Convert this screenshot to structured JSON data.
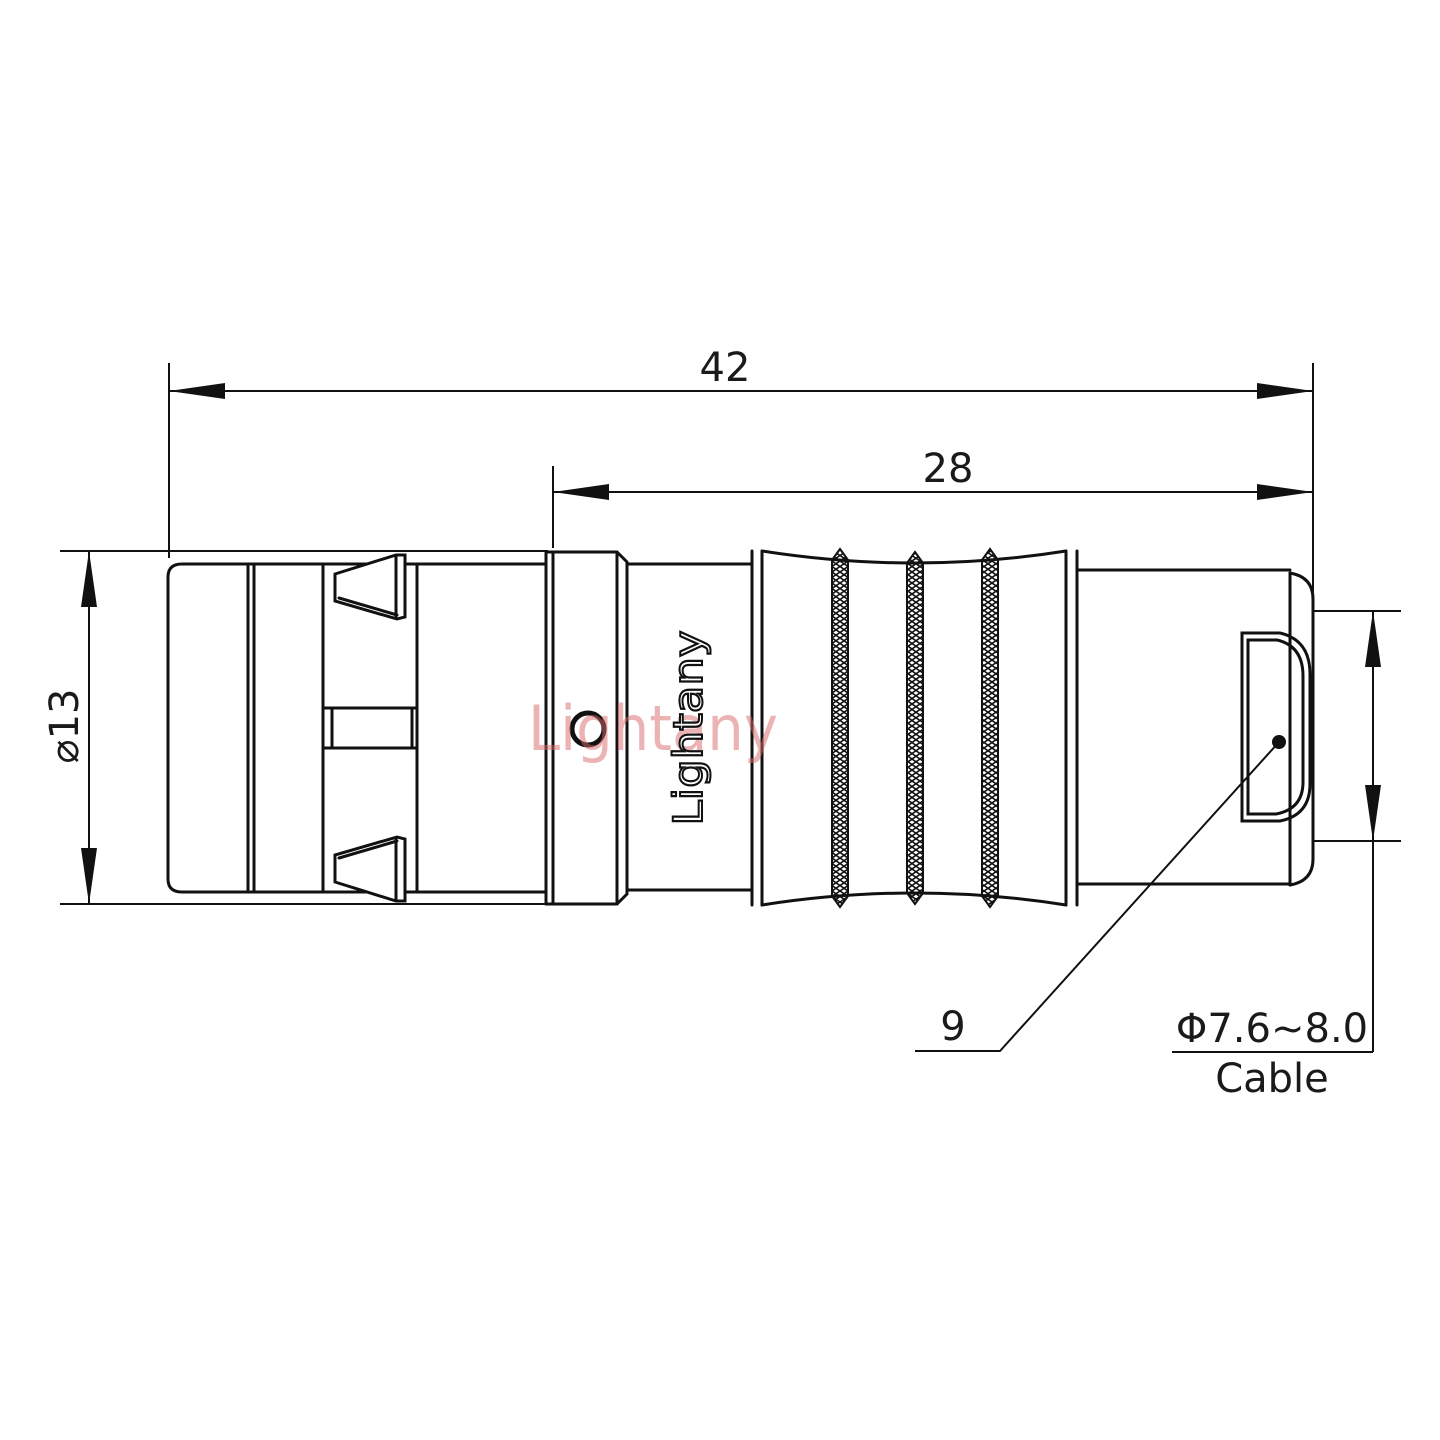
{
  "drawing": {
    "title": "connector-outline-drawing",
    "dim_overall_length": "42",
    "dim_rear_length": "28",
    "dim_body_diameter": "⌀13",
    "dim_nut": "9",
    "cable_spec": "Φ7.6~8.0",
    "cable_label": "Cable",
    "engraving": "Lightany",
    "watermark": "Lightany",
    "colors": {
      "line": "#111111",
      "watermark_pink": "#d96a6a",
      "background": "#ffffff"
    }
  }
}
